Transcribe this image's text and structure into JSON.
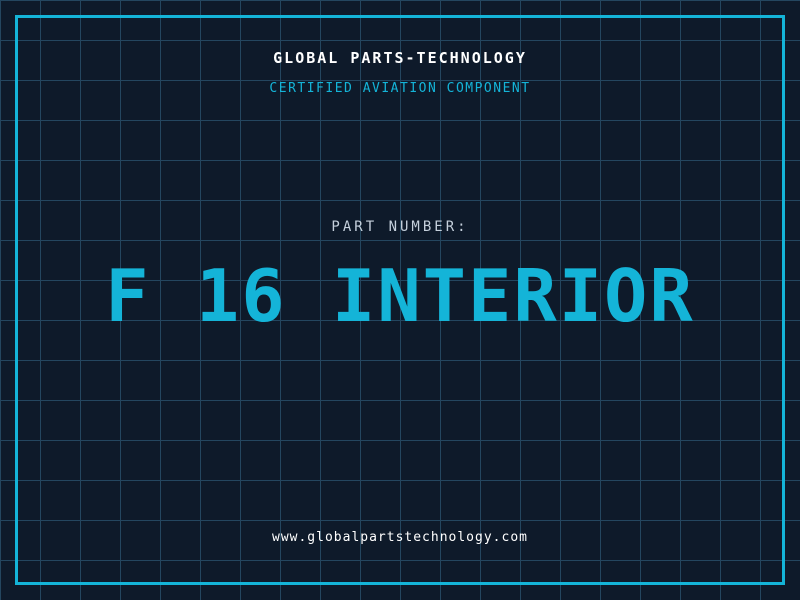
{
  "theme": {
    "background_color": "#0e1a2a",
    "grid_color": "#24465f",
    "accent_color": "#14b4d8",
    "text_white": "#ffffff",
    "text_muted": "#c5d0dc"
  },
  "header": {
    "company_name": "GLOBAL PARTS-TECHNOLOGY",
    "tagline": "CERTIFIED AVIATION COMPONENT"
  },
  "part": {
    "label": "PART NUMBER:",
    "number": "F 16 INTERIOR"
  },
  "footer": {
    "website": "www.globalpartstechnology.com"
  }
}
